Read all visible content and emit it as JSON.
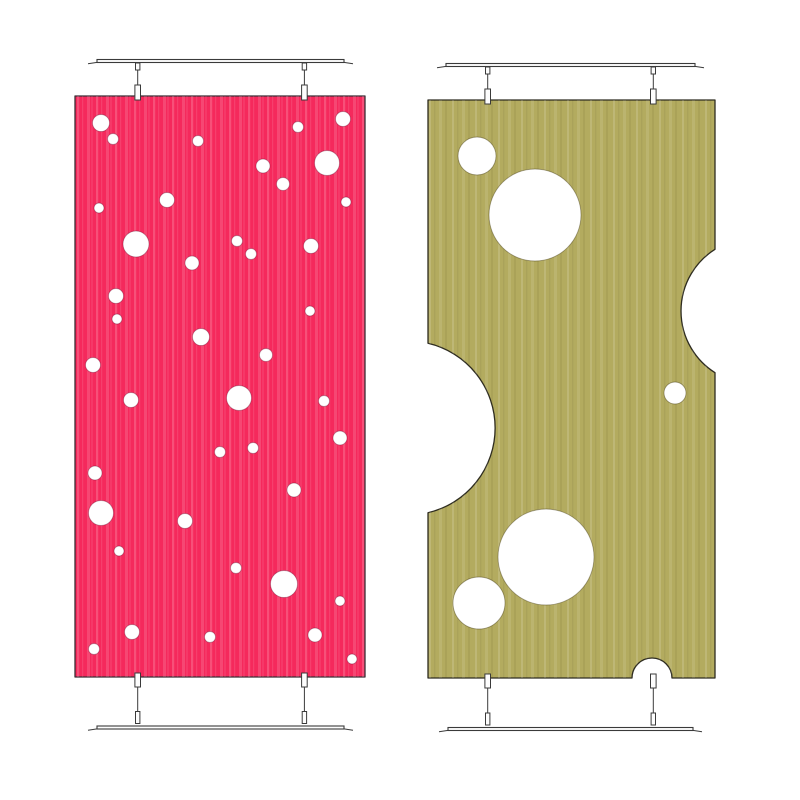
{
  "scene": {
    "description": "Two hanging decorative divider panels with circular cut-outs",
    "background": "#ffffff",
    "canvas": {
      "width": 800,
      "height": 800
    },
    "hardware_color": "#3a3a3a",
    "fitting_fill": "#fdfdfd",
    "hole_fill": "#ffffff"
  },
  "panels": [
    {
      "name": "pink-polka-dot-panel",
      "fill": "#f5295c",
      "outline": "#3a2f36",
      "hole_rim": "rgba(90,10,40,0.35)",
      "rect": {
        "x": 75,
        "y": 96,
        "w": 290,
        "h": 581
      },
      "texture": {
        "period": 19,
        "stripes": [
          {
            "x": 2,
            "w": 2.2,
            "color": "rgba(255,255,255,0.18)"
          },
          {
            "x": 7,
            "w": 1.2,
            "color": "rgba(255,255,255,0.10)"
          },
          {
            "x": 12,
            "w": 3.0,
            "color": "rgba(255,255,255,0.14)"
          },
          {
            "x": 16.5,
            "w": 1.0,
            "color": "rgba(255,190,205,0.20)"
          }
        ]
      },
      "holes": [
        {
          "cx": 26,
          "cy": 27,
          "r": 8.5
        },
        {
          "cx": 38,
          "cy": 43,
          "r": 5.5
        },
        {
          "cx": 123,
          "cy": 45,
          "r": 5.5
        },
        {
          "cx": 223,
          "cy": 31,
          "r": 5.5
        },
        {
          "cx": 268,
          "cy": 23,
          "r": 7.5
        },
        {
          "cx": 252,
          "cy": 67,
          "r": 12.5
        },
        {
          "cx": 188,
          "cy": 70,
          "r": 7
        },
        {
          "cx": 208,
          "cy": 88,
          "r": 6.5
        },
        {
          "cx": 271,
          "cy": 106,
          "r": 5
        },
        {
          "cx": 92,
          "cy": 104,
          "r": 7.5
        },
        {
          "cx": 24,
          "cy": 112,
          "r": 5
        },
        {
          "cx": 61,
          "cy": 148,
          "r": 13
        },
        {
          "cx": 162,
          "cy": 145,
          "r": 5.5
        },
        {
          "cx": 176,
          "cy": 158,
          "r": 5.5
        },
        {
          "cx": 236,
          "cy": 150,
          "r": 7.5
        },
        {
          "cx": 117,
          "cy": 167,
          "r": 7
        },
        {
          "cx": 41,
          "cy": 200,
          "r": 7.5
        },
        {
          "cx": 42,
          "cy": 223,
          "r": 5
        },
        {
          "cx": 235,
          "cy": 215,
          "r": 5
        },
        {
          "cx": 126,
          "cy": 241,
          "r": 8.5
        },
        {
          "cx": 191,
          "cy": 259,
          "r": 6.5
        },
        {
          "cx": 18,
          "cy": 269,
          "r": 7.5
        },
        {
          "cx": 56,
          "cy": 304,
          "r": 7.5
        },
        {
          "cx": 164,
          "cy": 302,
          "r": 12.5
        },
        {
          "cx": 249,
          "cy": 305,
          "r": 5.5
        },
        {
          "cx": 265,
          "cy": 342,
          "r": 7
        },
        {
          "cx": 145,
          "cy": 356,
          "r": 5.5
        },
        {
          "cx": 178,
          "cy": 352,
          "r": 5.5
        },
        {
          "cx": 20,
          "cy": 377,
          "r": 7
        },
        {
          "cx": 219,
          "cy": 394,
          "r": 7
        },
        {
          "cx": 26,
          "cy": 417,
          "r": 12.5
        },
        {
          "cx": 110,
          "cy": 425,
          "r": 7.5
        },
        {
          "cx": 44,
          "cy": 455,
          "r": 5
        },
        {
          "cx": 161,
          "cy": 472,
          "r": 5.5
        },
        {
          "cx": 209,
          "cy": 488,
          "r": 13.5
        },
        {
          "cx": 265,
          "cy": 505,
          "r": 5
        },
        {
          "cx": 57,
          "cy": 536,
          "r": 7.5
        },
        {
          "cx": 19,
          "cy": 553,
          "r": 5.5
        },
        {
          "cx": 135,
          "cy": 541,
          "r": 5.5
        },
        {
          "cx": 240,
          "cy": 539,
          "r": 7
        },
        {
          "cx": 277,
          "cy": 563,
          "r": 5
        }
      ],
      "edge_holes": [],
      "hardware": {
        "top_rail": {
          "x1": 97,
          "x2": 344,
          "y": 61
        },
        "bottom_rail": {
          "x1": 97,
          "x2": 344,
          "y": 727.5
        },
        "rod_xs": [
          137.7,
          304.4
        ]
      }
    },
    {
      "name": "olive-cheese-panel",
      "fill": "#b3ab5f",
      "outline": "#2e2c20",
      "hole_rim": "rgba(70,62,25,0.45)",
      "rect": {
        "x": 428,
        "y": 100,
        "w": 287,
        "h": 578
      },
      "texture": {
        "period": 23,
        "stripes": [
          {
            "x": 1,
            "w": 2.0,
            "color": "rgba(255,255,255,0.14)"
          },
          {
            "x": 6,
            "w": 1.4,
            "color": "rgba(0,0,0,0.05)"
          },
          {
            "x": 11,
            "w": 3.0,
            "color": "rgba(255,255,255,0.10)"
          },
          {
            "x": 17,
            "w": 2.0,
            "color": "rgba(86,80,30,0.10)"
          }
        ]
      },
      "holes": [
        {
          "cx": 49,
          "cy": 56,
          "r": 19
        },
        {
          "cx": 107,
          "cy": 115,
          "r": 46
        },
        {
          "cx": 247,
          "cy": 293,
          "r": 11
        },
        {
          "cx": 118,
          "cy": 457,
          "r": 48
        },
        {
          "cx": 51,
          "cy": 503,
          "r": 26
        }
      ],
      "edge_holes": [
        {
          "edge": "right",
          "cx": 326,
          "cy": 211,
          "r": 73
        },
        {
          "edge": "left",
          "cx": -20,
          "cy": 328,
          "r": 87
        },
        {
          "edge": "bottom",
          "cx": 224,
          "cy": 578,
          "r": 20
        }
      ],
      "hardware": {
        "top_rail": {
          "x1": 446,
          "x2": 695,
          "y": 65
        },
        "bottom_rail": {
          "x1": 448,
          "x2": 693,
          "y": 729
        },
        "rod_xs": [
          487.7,
          653.3
        ]
      }
    }
  ]
}
